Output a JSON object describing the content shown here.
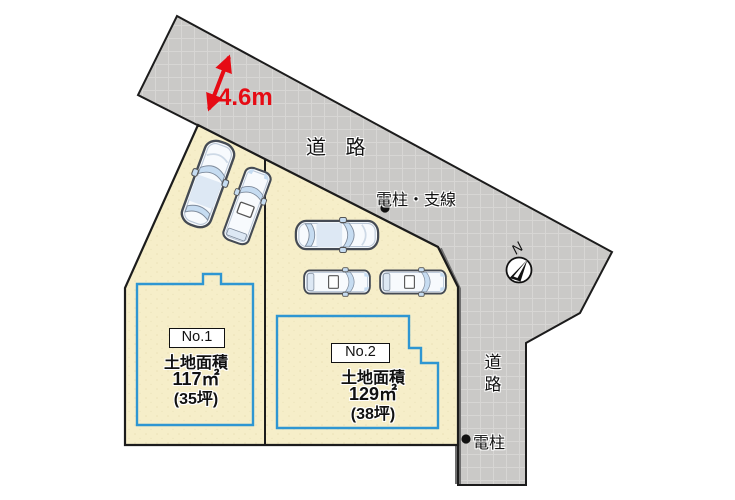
{
  "diagram": {
    "dimension_label": "4.6m",
    "road_label_top": "道 路",
    "road_label_right": [
      "道",
      "路"
    ],
    "pole_with_wire_label": "電柱・支線",
    "pole_label": "電柱",
    "compass_label": "N"
  },
  "parcels": [
    {
      "number_label": "No.1",
      "area_title": "土地面積",
      "area_sqm": "117㎡",
      "area_tsubo": "(35坪)"
    },
    {
      "number_label": "No.2",
      "area_title": "土地面積",
      "area_sqm": "129㎡",
      "area_tsubo": "(38坪)"
    }
  ],
  "colors": {
    "road_fill": "#cac9c7",
    "road_grid_line": "#d7d6d4",
    "parcel_fill": "#f6eec9",
    "parcel_speckle": "#ddd2a4",
    "footprint_outline": "#2e96d2",
    "dimension_red": "#e60b14",
    "line_black": "#1c1c1c",
    "boundary_shadow": "#6f6f6f",
    "car_outline": "#454b54",
    "car_glass": "#c6dcf1",
    "car_body": "#f7fafd"
  }
}
